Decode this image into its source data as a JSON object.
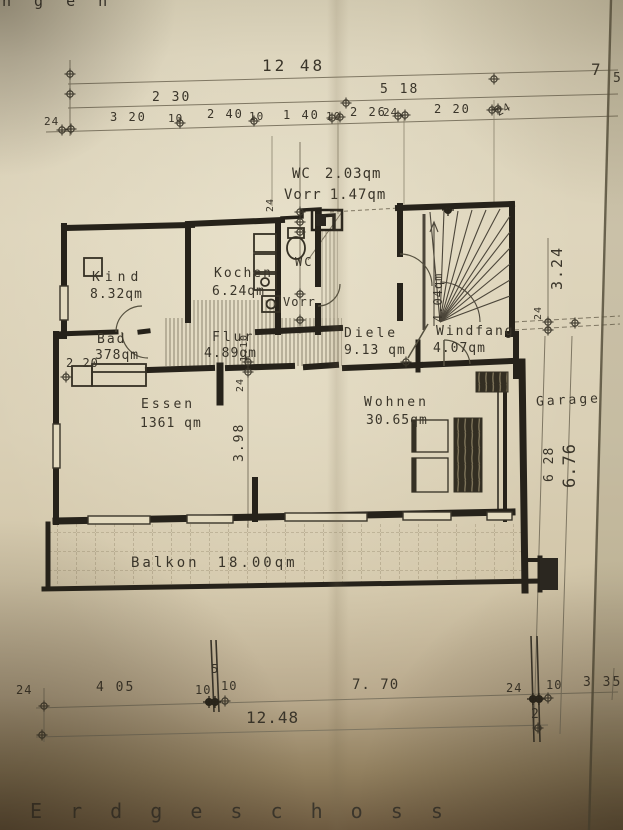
{
  "photo": {
    "corner_text": "n g e n",
    "title": "E r d g e s c h o s s"
  },
  "rooms": {
    "kind": {
      "name": "Kind",
      "area": "8.32qm"
    },
    "kochen": {
      "name": "Kochen",
      "area": "6.24qm"
    },
    "wc_note": {
      "name": "WC",
      "area": "2.03qm"
    },
    "vorr_note": {
      "name": "Vorr",
      "area": "1.47qm"
    },
    "wc": {
      "name": "WC"
    },
    "vorr": {
      "name": "Vorr"
    },
    "bad": {
      "name": "Bad",
      "area": "378qm"
    },
    "flur": {
      "name": "Flur",
      "area": "4.89qm"
    },
    "diele": {
      "name": "Diele",
      "area": "9.13 qm"
    },
    "windfang": {
      "name": "Windfang",
      "area": "4.07qm"
    },
    "treppe": {
      "area": "4.04qm"
    },
    "essen": {
      "name": "Essen",
      "area": "1361 qm"
    },
    "wohnen": {
      "name": "Wohnen",
      "area": "30.65qm"
    },
    "garage": {
      "name": "Garage"
    },
    "balkon": {
      "name": "Balkon",
      "area": "18.00qm"
    }
  },
  "dims": {
    "top_total": "12 48",
    "t230": "2 30",
    "t518": "5 18",
    "t7": "7",
    "t5": "5",
    "m24l": "24",
    "m320": "3 20",
    "m10a": "10",
    "m240": "2 40",
    "m10b": "10",
    "m140": "1 40",
    "m10c": "10",
    "m226": "2 26",
    "m24b": "24",
    "m220": "2 20",
    "m24c": "24",
    "wc24": "24",
    "bad220": "2 20",
    "flur110": "1.10",
    "mid24": "24",
    "v398": "3.98",
    "r324": "3.24",
    "r24": "24",
    "r628": "6 28",
    "r676": "6.76",
    "b24l": "24",
    "b405": "4 05",
    "b5": "5",
    "b10a": "10",
    "b10b": "10",
    "b770": "7. 70",
    "b24r": "24",
    "b10c": "10",
    "b335": "3 35",
    "b2": "2",
    "bottom_total": "12.48"
  }
}
